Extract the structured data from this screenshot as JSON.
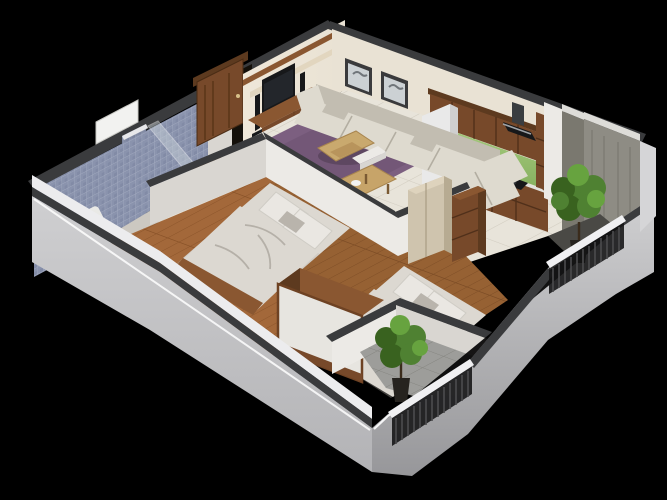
{
  "scene": {
    "kind": "3d-floor-plan-render",
    "subject": "isometric-cutaway-apartment-floor-plan",
    "background": "#000000",
    "rooms": [
      {
        "name": "bathroom",
        "position": "top-left",
        "features": [
          "blue-mosaic-tile-walls",
          "toilet",
          "glass-shower-screen",
          "wall-window",
          "tiled-partition"
        ]
      },
      {
        "name": "living-room",
        "position": "top-center",
        "features": [
          "tv-feature-wall",
          "flat-screen-tv",
          "speaker-towers",
          "wood-media-console",
          "framed-bird-print-1",
          "framed-bird-print-2",
          "l-shaped-cream-sofa",
          "purple-area-rug",
          "wood-coffee-table"
        ]
      },
      {
        "name": "kitchen",
        "position": "top-right",
        "features": [
          "wood-upper-cabinets",
          "wood-base-cabinets",
          "green-backsplash",
          "refrigerator",
          "chimney-range-hood",
          "black-cooktop",
          "counter-items"
        ]
      },
      {
        "name": "balcony-right",
        "position": "right",
        "features": [
          "exposed-concrete-walls",
          "potted-tree",
          "black-metal-railing",
          "dark-tile-floor"
        ]
      },
      {
        "name": "hallway-dining",
        "position": "center",
        "features": [
          "cream-tile-floor",
          "wood-dining-table",
          "white-bench",
          "wood-dresser",
          "dinner-plate"
        ]
      },
      {
        "name": "bedroom-1",
        "position": "center-left",
        "features": [
          "wood-plank-floor",
          "double-bed",
          "grey-white-bedding",
          "pillows",
          "wood-foot-bench",
          "white-wardrobe-unit"
        ]
      },
      {
        "name": "bedroom-2",
        "position": "center-right",
        "features": [
          "wood-plank-floor",
          "double-bed",
          "grey-white-bedding",
          "pillows",
          "tall-pale-closet",
          "brown-wardrobe"
        ]
      },
      {
        "name": "balcony-front",
        "position": "bottom",
        "features": [
          "grey-tile-floor",
          "potted-tree",
          "black-metal-railing"
        ]
      }
    ],
    "entry_door": {
      "name": "entry-door",
      "material": "dark-wood",
      "state": "open"
    }
  },
  "colors": {
    "bg": "#000000",
    "capDark": "#3a3b3d",
    "capDarker": "#2c2d2f",
    "facadeLight": "#cfcfd1",
    "facadeMid": "#b3b3b6",
    "facadeDark": "#97979a",
    "rimWhite": "#ececee",
    "wallWhite": "#eceae6",
    "wallShade": "#d9d6d1",
    "wallWarm": "#e9e2d4",
    "tvPanel": "#efe7d8",
    "tileCream": "#e8e4da",
    "tileGrout": "#d2cdc1",
    "bathFloor": "#ccc8c1",
    "bathTile": "#8a93ad",
    "bathTileDark": "#727c98",
    "bathTileLight": "#a2aabf",
    "woodDark": "#5d3a1f",
    "wood": "#77492a",
    "woodLight": "#8a5731",
    "woodPale": "#cfc4ae",
    "woodPaleSide": "#b7ab92",
    "woodFloor1": "#a3683a",
    "woodFloor1Dark": "#8a5329",
    "woodFloor2": "#966133",
    "woodFloor2Dark": "#7d4d26",
    "rugPurple": "#7c5f80",
    "rugPurpleDark": "#684e6c",
    "sofaCream": "#dedacf",
    "sofaShadow": "#c2bdb1",
    "bedLinen": "#dcd8d1",
    "bedLinenShade": "#b9b4ac",
    "pillowWhite": "#eae7e2",
    "greenSplash": "#a5c97d",
    "greenSplashDark": "#88b261",
    "fridgeWhite": "#e9e9e9",
    "applianceBlack": "#17181a",
    "steel": "#9ea2a6",
    "concrete": "#8e8c84",
    "concreteDark": "#7a786f",
    "plantGreen": "#4f8132",
    "plantGreenDark": "#39621f",
    "plantGreenLight": "#67a33f",
    "potBlack": "#26231f",
    "railBlack": "#131314",
    "balconyTile": "#9d9d9a",
    "balconyGrout": "#89898622",
    "glass": "#cfd8dc"
  }
}
